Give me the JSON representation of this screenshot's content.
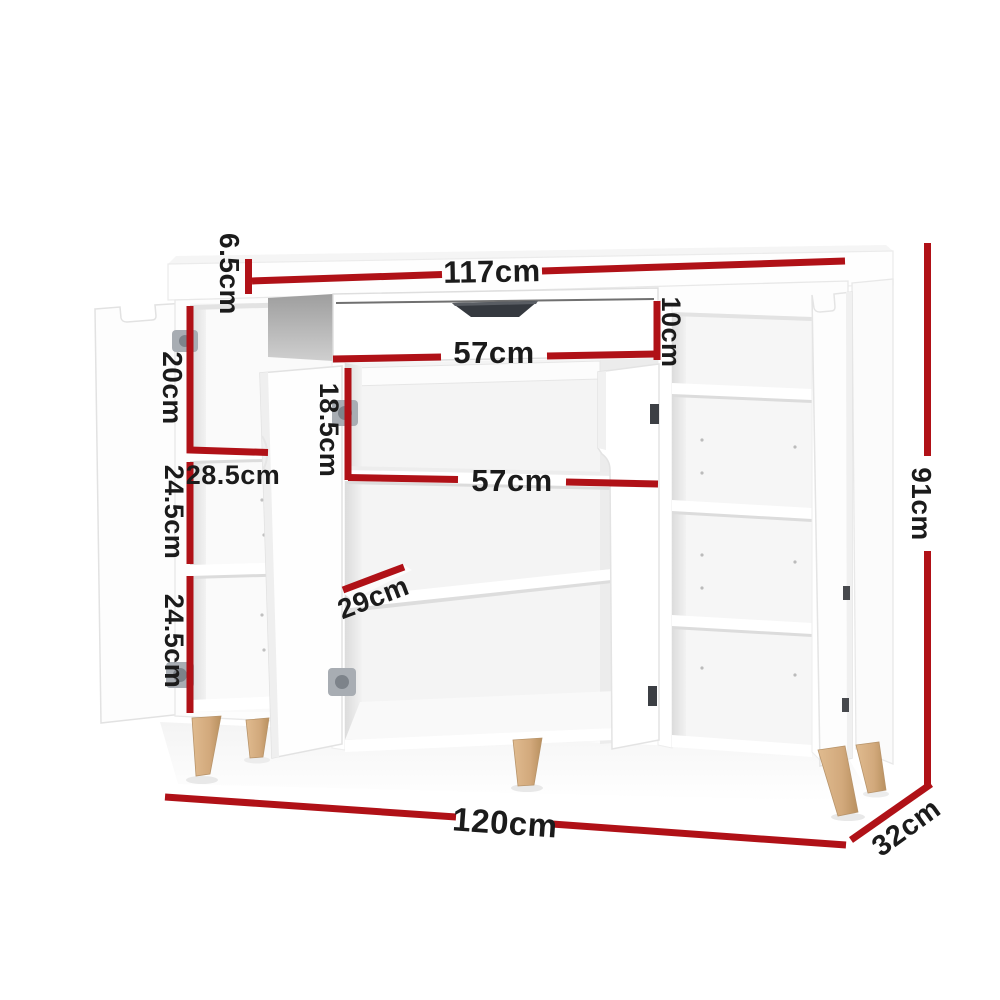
{
  "diagram": {
    "type": "furniture-dimension-diagram",
    "subject": "white shoe cabinet with open doors, drawer, shelves and wooden legs",
    "colors": {
      "dimension_line": "#b01117",
      "label_text": "#1b1b1b",
      "cabinet_body": "#ffffff",
      "interior_shadow": "#b5b5b5",
      "drawer_handle": "#35393f",
      "leg_wood": "#d2a97c",
      "hinge_metal": "#9aa0a6"
    },
    "labels": {
      "d65": {
        "text": "6.5cm",
        "measures": "top-panel-thickness"
      },
      "d117": {
        "text": "117cm",
        "measures": "top-inner-width"
      },
      "d10": {
        "text": "10cm",
        "measures": "drawer-height"
      },
      "d57a": {
        "text": "57cm",
        "measures": "drawer-width"
      },
      "d20": {
        "text": "20cm",
        "measures": "left-top-compartment-height"
      },
      "d285": {
        "text": "28.5cm",
        "measures": "left-compartment-width"
      },
      "d245a": {
        "text": "24.5cm",
        "measures": "left-middle-compartment-height"
      },
      "d245b": {
        "text": "24.5cm",
        "measures": "left-bottom-compartment-height"
      },
      "d185": {
        "text": "18.5cm",
        "measures": "middle-top-opening-height"
      },
      "d57b": {
        "text": "57cm",
        "measures": "middle-opening-width"
      },
      "d29": {
        "text": "29cm",
        "measures": "shelf-depth"
      },
      "d91": {
        "text": "91cm",
        "measures": "overall-height"
      },
      "d120": {
        "text": "120cm",
        "measures": "overall-width"
      },
      "d32": {
        "text": "32cm",
        "measures": "overall-depth"
      }
    }
  }
}
